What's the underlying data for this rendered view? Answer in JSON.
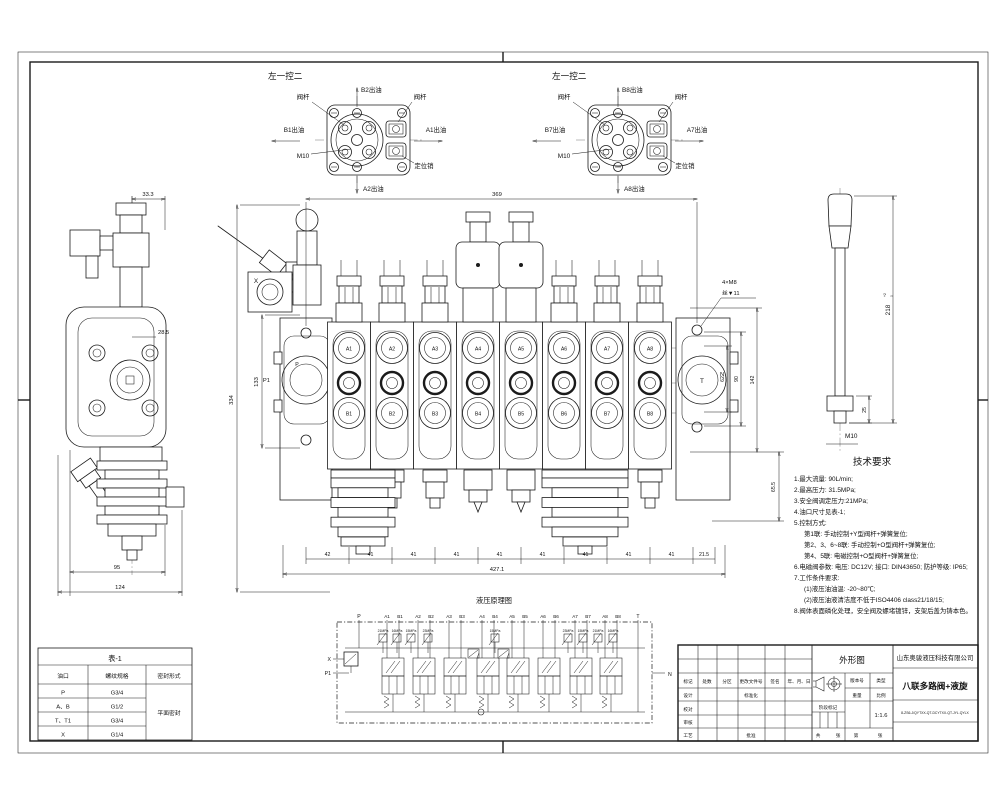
{
  "detail_left": {
    "title": "左一控二",
    "stem_left": "阀杆",
    "stem_right": "阀杆",
    "out_up": "B2出油",
    "out_left": "B1出油",
    "out_right": "A1出油",
    "out_down": "A2出油",
    "thread": "M10",
    "pin": "定位销"
  },
  "detail_right": {
    "title": "左一控二",
    "stem_left": "阀杆",
    "stem_right": "阀杆",
    "out_up": "B8出油",
    "out_left": "B7出油",
    "out_right": "A7出油",
    "out_down": "A8出油",
    "thread": "M10",
    "pin": "定位销"
  },
  "side_view": {
    "dim_top": "33.3",
    "dim_body": "28.5",
    "dim_w1": "95",
    "dim_w2": "124"
  },
  "main_view": {
    "ports_top": [
      "A1",
      "A2",
      "A3",
      "A4",
      "A5",
      "A6",
      "A7",
      "A8"
    ],
    "ports_bottom": [
      "B1",
      "B2",
      "B3",
      "B4",
      "B5",
      "B6",
      "B7",
      "B8"
    ],
    "solenoid_sections": [
      4,
      5
    ],
    "port_p": "P",
    "port_p1": "P1",
    "port_x": "X",
    "port_t": "T",
    "port_n": "N",
    "dim_top": "369",
    "dim_height": "334",
    "dim_inlet": "133",
    "dims_bottom": [
      "42",
      "41",
      "41",
      "41",
      "41",
      "41",
      "41",
      "41",
      "41",
      "21.5"
    ],
    "dim_overall": "427.1",
    "dims_right": [
      "62",
      "90",
      "142"
    ],
    "dim_right_lower": "65.5",
    "note_m8": "4×M8",
    "note_m8_depth": "丝▼11"
  },
  "handle": {
    "dim_length": "218",
    "tol_up": "+2",
    "tol_dn": "0",
    "dim_nut": "25",
    "thread": "M10"
  },
  "tech": {
    "title": "技术要求",
    "lines": [
      "1.最大流量: 90L/min;",
      "2.最高压力: 31.5MPa;",
      "3.安全阀调定压力:21MPa;",
      "4.油口尺寸见表-1;",
      "5.控制方式:",
      "第1联: 手动控制+Y型阀杆+弹簧复位;",
      "第2、3、6~8联: 手动控制+O型阀杆+弹簧复位;",
      "第4、5联: 电磁控制+O型阀杆+弹簧复位;",
      "6.电磁阀参数: 电压: DC12V; 接口: DIN43650; 防护等级: IP65;",
      "7.工作条件要求:",
      "(1)液压油油温: -20~80℃;",
      "(2)液压油液清洁度不低于ISO4406 class21/18/15;",
      "8.阀体表面磷化处理，安全阀及螺堵镀锌，支架后盖为铸本色。"
    ]
  },
  "schematic": {
    "title": "液压原理图",
    "port_p": "P",
    "port_t": "T",
    "port_x": "X",
    "port_p1": "P1",
    "port_n": "N",
    "pairs": [
      [
        "A1",
        "B1"
      ],
      [
        "A2",
        "B2"
      ],
      [
        "A3",
        "B3"
      ],
      [
        "A4",
        "B4"
      ],
      [
        "A5",
        "B5"
      ],
      [
        "A6",
        "B6"
      ],
      [
        "A7",
        "B7"
      ],
      [
        "A8",
        "B8"
      ]
    ],
    "relief_labels": [
      "21MPa",
      "16MPa",
      "15MPa",
      "23MPa",
      "15MPa",
      "23MPa",
      "15MPa",
      "21MPa",
      "16MPa"
    ]
  },
  "table": {
    "title": "表-1",
    "headers": [
      "油口",
      "螺纹规格",
      "密封形式"
    ],
    "rows": [
      [
        "P",
        "G3/4"
      ],
      [
        "A、B",
        "G1/2"
      ],
      [
        "T、T1",
        "G3/4"
      ],
      [
        "X",
        "G1/4"
      ]
    ],
    "seal": "平面密封"
  },
  "title_block": {
    "drawing_type": "外形图",
    "company": "山东奥骏液压科技有限公司",
    "product_name": "八联多路阀+液旋",
    "part_number": "8-ZS6-J/QYTXX-QT-DCYTXX-QT-JYL.QYLX",
    "col_version": "版本号",
    "col_type": "类型",
    "row_headers": [
      "标记",
      "处数",
      "分区",
      "更改文件号",
      "签名",
      "年、月、日"
    ],
    "left_rows": [
      "设计",
      "校对",
      "审核",
      "工艺"
    ],
    "standardization": "标准化",
    "approve": "批准",
    "stage_mark": "阶段标记",
    "weight": "重量",
    "scale": "比例",
    "scale_value": "1:1.6",
    "sheet_total": "共",
    "sheet_unit1": "张",
    "sheet_index": "第",
    "sheet_unit2": "张"
  }
}
